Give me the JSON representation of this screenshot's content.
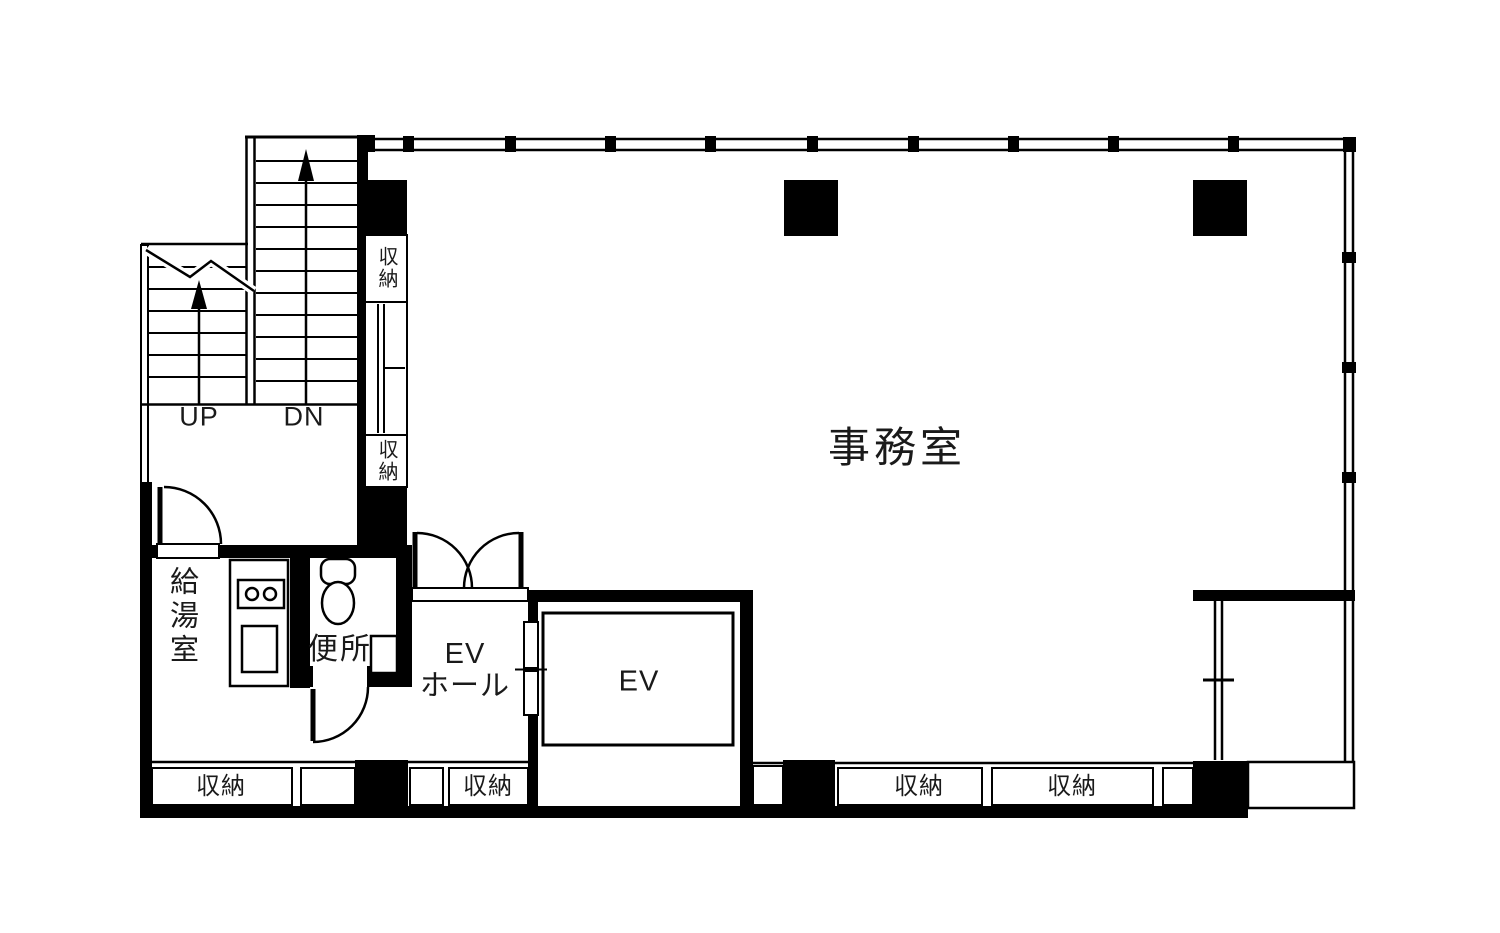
{
  "colors": {
    "line": "#000000",
    "wall_fill": "#000000",
    "background": "#ffffff"
  },
  "floorplan": {
    "rooms": {
      "office": {
        "label": "事務室"
      },
      "kitchenette": {
        "label": "給湯室"
      },
      "toilet": {
        "label": "便所"
      },
      "elevator_hall": {
        "line1": "EV",
        "line2": "ホール"
      },
      "elevator": {
        "label": "EV"
      }
    },
    "stairs": {
      "up_label": "UP",
      "down_label": "DN"
    },
    "closets": {
      "stair_upper": "収納",
      "stair_lower": "収納",
      "bottom_left": "収納",
      "elevator_hall": "収納",
      "bottom_right_1": "収納",
      "bottom_right_2": "収納"
    },
    "icons": {
      "stair_up_arrow": "up-arrow",
      "stair_down_arrow": "up-arrow",
      "stair_break": "zigzag-cut-line",
      "toilet_fixture": "toilet-tank-and-bowl",
      "hand_basin": "small-square-basin",
      "stove": "two-burner-stove",
      "sink": "square-sink",
      "door_swings": "quarter-circle-arc",
      "elevator_door": "double-slide-door",
      "windows": "double-line-with-mullions",
      "pillars": "solid-black-columns"
    }
  }
}
